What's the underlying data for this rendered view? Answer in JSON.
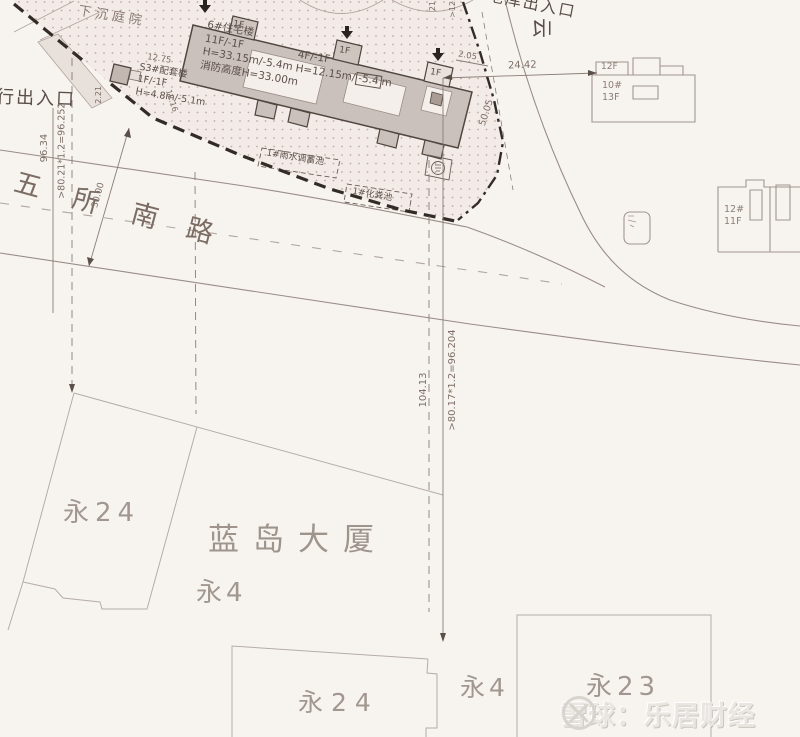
{
  "labels": {
    "sunken_courtyard": "下沉庭院",
    "pedestrian_entrance": "行出入口",
    "garage_entrance": "地库出入口",
    "yun": "云",
    "rainwater_pool": "1#雨水调蓄池",
    "septic_tank": "1#化粪池"
  },
  "buildings": {
    "b6_name": "6#住宅楼",
    "b6_floors": "11F/-1F",
    "b6_height": "H=33.15m/-5.4m",
    "b6_fire": "消防高度H=33.00m",
    "b4_floors": "4F/-1F",
    "b4_height_prefix": "H=12.15m/",
    "b4_height_boxed": "-5.4",
    "b4_height_suffix": "m",
    "s3_name": "S3#配套楼",
    "s3_floors": "1F/-1F",
    "s3_height": "H=4.8m/-5.1m",
    "floor1": "1F",
    "r1_top": "12F",
    "r1_name": "10#",
    "r1_floors": "13F",
    "r2_name": "12#",
    "r2_floors": "11F"
  },
  "road": {
    "c1": "五",
    "c2": "所",
    "c3": "南",
    "c4": "路"
  },
  "dims": {
    "left_total": "96.34",
    "left_formula": ">80.21*1.2=96.252",
    "road_width": "30.00",
    "center_total": "104.13",
    "center_formula": ">80.17*1.2=96.204",
    "top_width": "24.42",
    "ramp_len": "50.05",
    "gap": "2.05",
    "s3_dim": "12.75",
    "s3_w": "2.21",
    "s3_d": "12.16",
    "top_partial_a": "21.",
    "top_partial_b": ">12.15m*1.2"
  },
  "parcels": {
    "mid_yong24": "永24",
    "landao": "蓝岛大厦",
    "mid_yong4": "永4",
    "bottom_yong24": "永24",
    "bottom_yong4": "永4",
    "bottom_yong23": "永23"
  },
  "watermark": {
    "source": "雪球：乐居财经"
  },
  "colors": {
    "paper": "#f7f4f0",
    "site_fill": "#f3ebe7",
    "building_fill": "#cbc1bc",
    "boundary": "#332b26",
    "line": "#8a7c76",
    "hand_label": "#a29790"
  }
}
